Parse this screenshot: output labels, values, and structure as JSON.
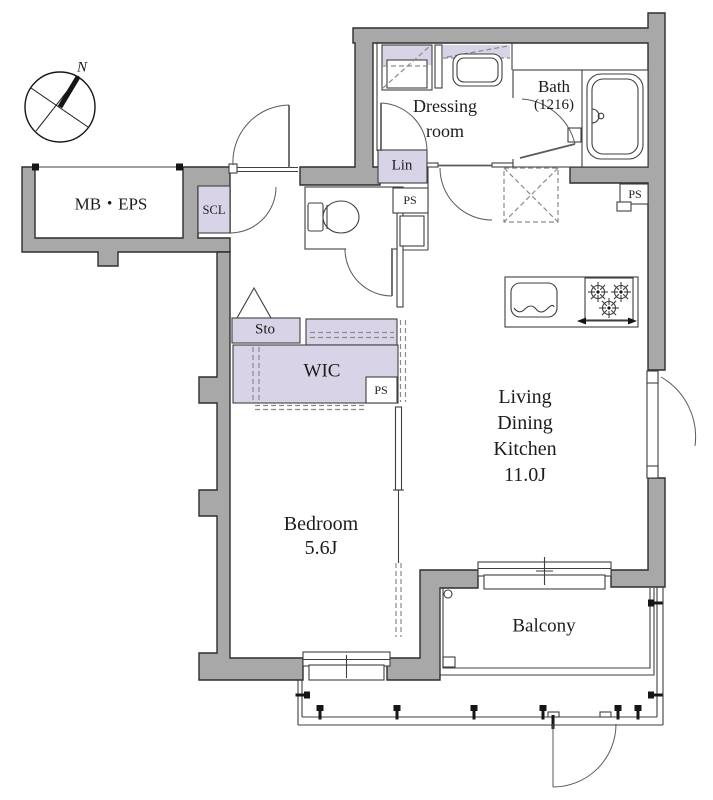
{
  "colors": {
    "wall": "#a8a8a8",
    "wallline": "#2e2e2e",
    "line": "#3f3f3f",
    "accent": "#d9d3e8",
    "dash": "#8a8a8a",
    "door": "#5a5a5a",
    "text": "#1c1c1c"
  },
  "compass": {
    "north_label": "N"
  },
  "labels": {
    "mb_eps": "MB・EPS",
    "scl": "SCL",
    "dressing_1": "Dressing",
    "dressing_2": "room",
    "lin": "Lin",
    "bath_1": "Bath",
    "bath_2": "(1216)",
    "ps": "PS",
    "sto": "Sto",
    "wic": "WIC",
    "ldk_1": "Living",
    "ldk_2": "Dining",
    "ldk_3": "Kitchen",
    "ldk_4": "11.0J",
    "bedroom_1": "Bedroom",
    "bedroom_2": "5.6J",
    "balcony": "Balcony"
  }
}
